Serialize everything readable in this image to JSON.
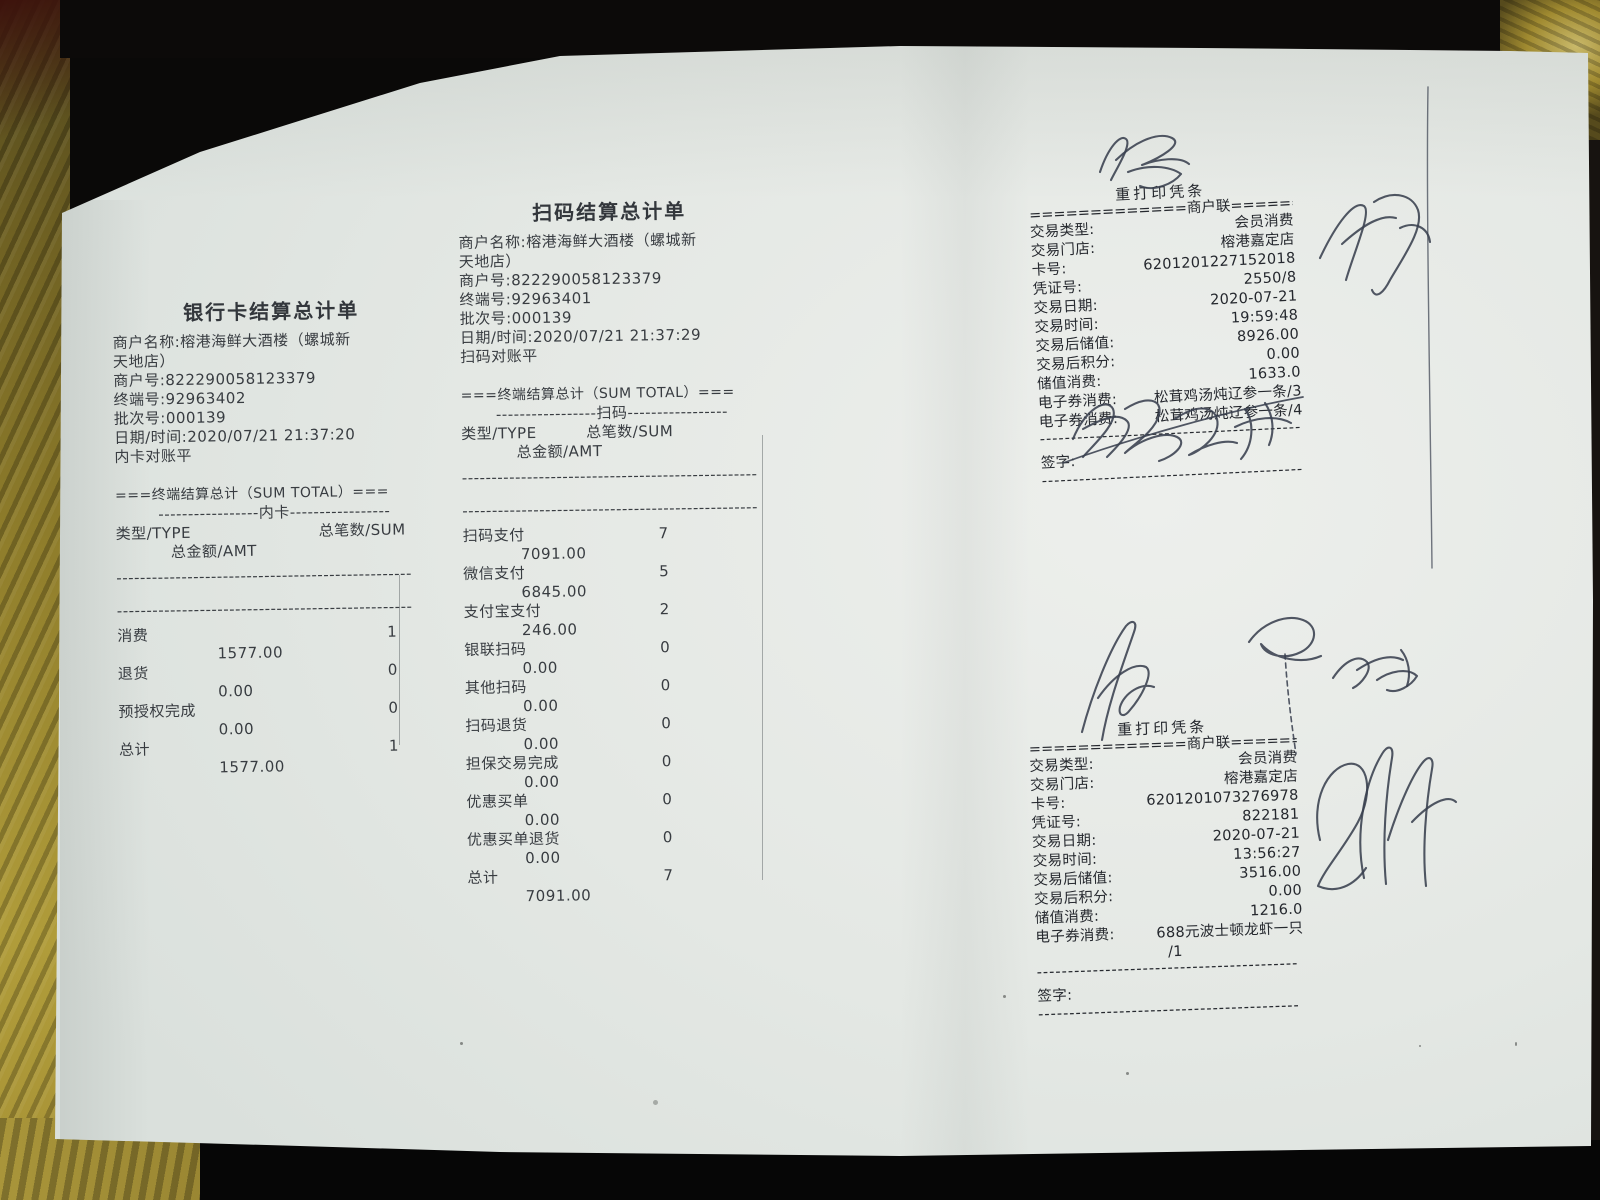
{
  "colors": {
    "paper": "#e6e9e6",
    "cloth_gold": "#9b8830",
    "background_black": "#0a0908",
    "pen_ink": "#39404e",
    "print_ink": "#25282e"
  },
  "left_receipt": {
    "title": "银行卡结算总计单",
    "merchant_name_line1": "商户名称:榕港海鲜大酒楼（螺城新",
    "merchant_name_line2": "天地店）",
    "merchant_no": "商户号:822290058123379",
    "terminal_no": "终端号:92963402",
    "batch_no": "批次号:000139",
    "datetime": "日期/时间:2020/07/21 21:37:20",
    "note": "内卡对账平",
    "section_header": "===终端结算总计（SUM TOTAL）===",
    "section_sub": "-----------------内卡-----------------",
    "col_type": "类型/TYPE",
    "col_sum": "总笔数/SUM",
    "col_amt": "总金额/AMT",
    "divider": "--------------------------------------------------",
    "rows": [
      {
        "type": "消费",
        "count": "1",
        "amount": "1577.00"
      },
      {
        "type": "退货",
        "count": "0",
        "amount": "0.00"
      },
      {
        "type": "预授权完成",
        "count": "0",
        "amount": "0.00"
      },
      {
        "type": "总计",
        "count": "1",
        "amount": "1577.00"
      }
    ]
  },
  "middle_receipt": {
    "title": "扫码结算总计单",
    "merchant_name_line1": "商户名称:榕港海鲜大酒楼（螺城新",
    "merchant_name_line2": "天地店）",
    "merchant_no": "商户号:822290058123379",
    "terminal_no": "终端号:92963401",
    "batch_no": "批次号:000139",
    "datetime": "日期/时间:2020/07/21 21:37:29",
    "note": "扫码对账平",
    "section_header": "===终端结算总计（SUM TOTAL）===",
    "section_sub": "-----------------扫码-----------------",
    "col_type": "类型/TYPE",
    "col_sum": "总笔数/SUM",
    "col_amt": "总金额/AMT",
    "divider": "--------------------------------------------------",
    "rows": [
      {
        "type": "扫码支付",
        "count": "7",
        "amount": "7091.00"
      },
      {
        "type": "微信支付",
        "count": "5",
        "amount": "6845.00"
      },
      {
        "type": "支付宝支付",
        "count": "2",
        "amount": "246.00"
      },
      {
        "type": "银联扫码",
        "count": "0",
        "amount": "0.00"
      },
      {
        "type": "其他扫码",
        "count": "0",
        "amount": "0.00"
      },
      {
        "type": "扫码退货",
        "count": "0",
        "amount": "0.00"
      },
      {
        "type": "担保交易完成",
        "count": "0",
        "amount": "0.00"
      },
      {
        "type": "优惠买单",
        "count": "0",
        "amount": "0.00"
      },
      {
        "type": "优惠买单退货",
        "count": "0",
        "amount": "0.00"
      },
      {
        "type": "总计",
        "count": "7",
        "amount": "7091.00"
      }
    ]
  },
  "top_right_slip": {
    "title": "重打印凭条",
    "copy_line": "=============商户联=============",
    "rows": [
      {
        "label": "交易类型:",
        "value": "会员消费"
      },
      {
        "label": "交易门店:",
        "value": "榕港嘉定店"
      },
      {
        "label": "卡号:",
        "value": "6201201227152018"
      },
      {
        "label": "凭证号:",
        "value": "2550/8"
      },
      {
        "label": "交易日期:",
        "value": "2020-07-21"
      },
      {
        "label": "交易时间:",
        "value": "19:59:48"
      },
      {
        "label": "交易后储值:",
        "value": "8926.00"
      },
      {
        "label": "交易后积分:",
        "value": "0.00"
      },
      {
        "label": "储值消费:",
        "value": "1633.0"
      },
      {
        "label": "电子券消费:",
        "value": "松茸鸡汤炖辽参一条/3"
      },
      {
        "label": "电子券消费:",
        "value": "松茸鸡汤炖辽参一条/4"
      }
    ],
    "divider": "------------------------------------------",
    "sign_label": "签字:"
  },
  "bottom_right_slip": {
    "title": "重打印凭条",
    "copy_line": "=============商户联=============",
    "rows": [
      {
        "label": "交易类型:",
        "value": "会员消费"
      },
      {
        "label": "交易门店:",
        "value": "榕港嘉定店"
      },
      {
        "label": "卡号:",
        "value": "6201201073276978"
      },
      {
        "label": "凭证号:",
        "value": "822181"
      },
      {
        "label": "交易日期:",
        "value": "2020-07-21"
      },
      {
        "label": "交易时间:",
        "value": "13:56:27"
      },
      {
        "label": "交易后储值:",
        "value": "3516.00"
      },
      {
        "label": "交易后积分:",
        "value": "0.00"
      },
      {
        "label": "储值消费:",
        "value": "1216.0"
      },
      {
        "label": "电子券消费:",
        "value": "688元波士顿龙虾一只"
      }
    ],
    "voucher_wrap": "/1",
    "divider": "------------------------------------------",
    "sign_label": "签字:"
  }
}
